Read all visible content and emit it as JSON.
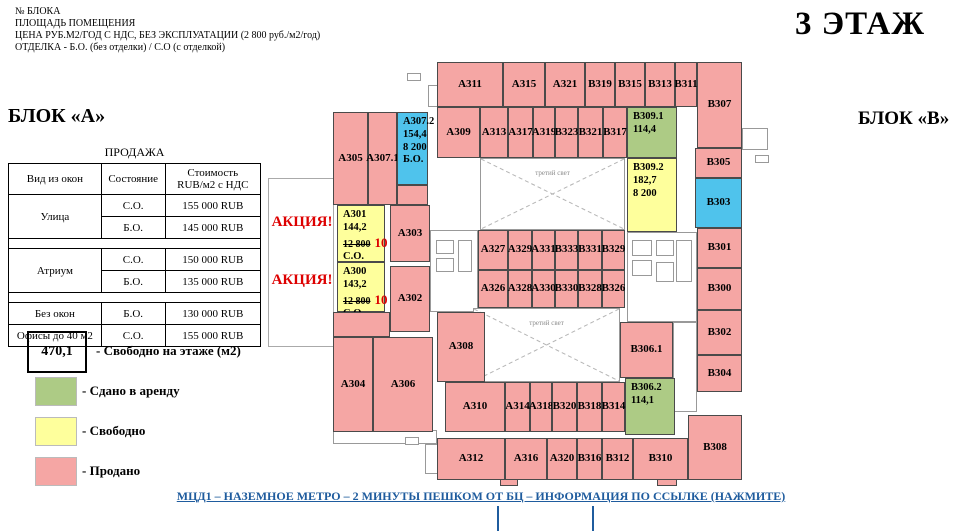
{
  "header_notes": [
    "№ БЛОКА",
    "ПЛОЩАДЬ ПОМЕЩЕНИЯ",
    "ЦЕНА РУБ.М2/ГОД С НДС, БЕЗ ЭКСПЛУАТАЦИИ (2 800 руб./м2/год)",
    "ОТДЕЛКА - Б.О. (без отделки) / С.О (с отделкой)"
  ],
  "floor_title": "3 ЭТАЖ",
  "block_a_label": "БЛОК «А»",
  "block_b_label": "БЛОК «В»",
  "sales": {
    "title": "ПРОДАЖА",
    "col_headers": [
      "Вид из окон",
      "Состояние",
      "Стоимость\nRUB/м2 с НДС"
    ],
    "groups": [
      {
        "view": "Улица",
        "rows": [
          [
            "С.О.",
            "155 000 RUB"
          ],
          [
            "Б.О.",
            "145 000 RUB"
          ]
        ],
        "spacer_after": true
      },
      {
        "view": "Атриум",
        "rows": [
          [
            "С.О.",
            "150 000 RUB"
          ],
          [
            "Б.О.",
            "135 000 RUB"
          ]
        ],
        "spacer_after": true
      },
      {
        "view": "Без окон",
        "rows": [
          [
            "Б.О.",
            "130 000 RUB"
          ]
        ],
        "spacer_after": false
      },
      {
        "view": "Офисы до 40 м2",
        "rows": [
          [
            "С.О.",
            "155 000 RUB"
          ]
        ],
        "spacer_after": false
      }
    ]
  },
  "legend": {
    "free_area_value": "470,1",
    "free_area_label": "- Свободно на этаже (м2)",
    "items": [
      {
        "status": "rented",
        "label": "- Сдано в аренду"
      },
      {
        "status": "free",
        "label": "- Свободно"
      },
      {
        "status": "sold",
        "label": "- Продано"
      }
    ]
  },
  "promo_labels": [
    "АКЦИЯ!",
    "АКЦИЯ!"
  ],
  "footer_link": "МЦД1 – НАЗЕМНОЕ МЕТРО – 2 МИНУТЫ ПЕШКОМ ОТ БЦ – ИНФОРМАЦИЯ ПО ССЫЛКЕ (НАЖМИТЕ)",
  "colors": {
    "sold": "#f5a6a4",
    "free": "#feff9c",
    "rented": "#adcb85",
    "special": "#4fc3ec",
    "promo_red": "#dd0000",
    "link_blue": "#1f5c9e",
    "none": "#ffffff"
  },
  "plan": {
    "atrium_label": "третий свет",
    "atriums": [
      {
        "x": 480,
        "y": 158,
        "w": 145,
        "h": 72
      },
      {
        "x": 473,
        "y": 308,
        "w": 147,
        "h": 74
      }
    ],
    "rooms": [
      {
        "id": "А311",
        "x": 437,
        "y": 62,
        "w": 66,
        "h": 45,
        "status": "sold"
      },
      {
        "id": "А315",
        "x": 503,
        "y": 62,
        "w": 42,
        "h": 45,
        "status": "sold"
      },
      {
        "id": "А321",
        "x": 545,
        "y": 62,
        "w": 40,
        "h": 45,
        "status": "sold"
      },
      {
        "id": "В319",
        "x": 585,
        "y": 62,
        "w": 30,
        "h": 45,
        "status": "sold"
      },
      {
        "id": "В315",
        "x": 615,
        "y": 62,
        "w": 30,
        "h": 45,
        "status": "sold"
      },
      {
        "id": "В313",
        "x": 645,
        "y": 62,
        "w": 30,
        "h": 45,
        "status": "sold"
      },
      {
        "id": "В311",
        "x": 675,
        "y": 62,
        "w": 22,
        "h": 45,
        "status": "sold"
      },
      {
        "id": "В307",
        "x": 697,
        "y": 62,
        "w": 45,
        "h": 86,
        "status": "sold"
      },
      {
        "id": "А309",
        "x": 437,
        "y": 107,
        "w": 43,
        "h": 51,
        "status": "sold"
      },
      {
        "id": "А313",
        "x": 480,
        "y": 107,
        "w": 28,
        "h": 51,
        "status": "sold"
      },
      {
        "id": "А317",
        "x": 508,
        "y": 107,
        "w": 25,
        "h": 51,
        "status": "sold"
      },
      {
        "id": "А319",
        "x": 533,
        "y": 107,
        "w": 22,
        "h": 51,
        "status": "sold"
      },
      {
        "id": "В323",
        "x": 555,
        "y": 107,
        "w": 23,
        "h": 51,
        "status": "sold"
      },
      {
        "id": "В321",
        "x": 578,
        "y": 107,
        "w": 25,
        "h": 51,
        "status": "sold"
      },
      {
        "id": "В317",
        "x": 603,
        "y": 107,
        "w": 24,
        "h": 51,
        "status": "sold"
      },
      {
        "id": "В309.1",
        "x": 627,
        "y": 107,
        "w": 50,
        "h": 51,
        "status": "rented",
        "lines": [
          "114,4"
        ]
      },
      {
        "id": "В309.2",
        "x": 627,
        "y": 158,
        "w": 50,
        "h": 74,
        "status": "free",
        "lines": [
          "182,7",
          "8 200"
        ]
      },
      {
        "id": "В305",
        "x": 695,
        "y": 148,
        "w": 47,
        "h": 30,
        "status": "sold"
      },
      {
        "id": "В303",
        "x": 695,
        "y": 178,
        "w": 47,
        "h": 50,
        "status": "special"
      },
      {
        "id": "В301",
        "x": 697,
        "y": 228,
        "w": 45,
        "h": 40,
        "status": "sold"
      },
      {
        "id": "В300",
        "x": 697,
        "y": 268,
        "w": 45,
        "h": 42,
        "status": "sold"
      },
      {
        "id": "В302",
        "x": 697,
        "y": 310,
        "w": 45,
        "h": 45,
        "status": "sold"
      },
      {
        "id": "В304",
        "x": 697,
        "y": 355,
        "w": 45,
        "h": 37,
        "status": "sold"
      },
      {
        "id": "В308",
        "x": 688,
        "y": 415,
        "w": 54,
        "h": 65,
        "status": "sold"
      },
      {
        "id": "А305",
        "x": 333,
        "y": 112,
        "w": 35,
        "h": 93,
        "status": "sold"
      },
      {
        "id": "А307.1",
        "x": 368,
        "y": 112,
        "w": 29,
        "h": 93,
        "status": "sold"
      },
      {
        "id": "А307.2",
        "x": 397,
        "y": 112,
        "w": 31,
        "h": 73,
        "status": "special",
        "lines": [
          "154,4",
          "8 200",
          "Б.О."
        ]
      },
      {
        "id": "",
        "x": 397,
        "y": 185,
        "w": 31,
        "h": 20,
        "status": "sold"
      },
      {
        "id": "А301",
        "x": 337,
        "y": 205,
        "w": 48,
        "h": 57,
        "status": "free",
        "lines": [
          "144,2",
          {
            "old": "12 800",
            "new": "10 500"
          },
          "С.О."
        ]
      },
      {
        "id": "А303",
        "x": 390,
        "y": 205,
        "w": 40,
        "h": 57,
        "status": "sold"
      },
      {
        "id": "А300",
        "x": 337,
        "y": 262,
        "w": 48,
        "h": 50,
        "status": "free",
        "lines": [
          "143,2",
          {
            "old": "12 800",
            "new": "10 500"
          },
          "С.О."
        ]
      },
      {
        "id": "А302",
        "x": 390,
        "y": 266,
        "w": 40,
        "h": 66,
        "status": "sold"
      },
      {
        "id": "",
        "x": 333,
        "y": 312,
        "w": 57,
        "h": 25,
        "status": "sold"
      },
      {
        "id": "А304",
        "x": 333,
        "y": 337,
        "w": 40,
        "h": 95,
        "status": "sold"
      },
      {
        "id": "А306",
        "x": 373,
        "y": 337,
        "w": 60,
        "h": 95,
        "status": "sold"
      },
      {
        "id": "А308",
        "x": 437,
        "y": 312,
        "w": 48,
        "h": 70,
        "status": "sold"
      },
      {
        "id": "А327",
        "x": 478,
        "y": 230,
        "w": 30,
        "h": 40,
        "status": "sold"
      },
      {
        "id": "А329",
        "x": 508,
        "y": 230,
        "w": 24,
        "h": 40,
        "status": "sold"
      },
      {
        "id": "А331",
        "x": 532,
        "y": 230,
        "w": 23,
        "h": 40,
        "status": "sold"
      },
      {
        "id": "В333",
        "x": 555,
        "y": 230,
        "w": 23,
        "h": 40,
        "status": "sold"
      },
      {
        "id": "В331",
        "x": 578,
        "y": 230,
        "w": 24,
        "h": 40,
        "status": "sold"
      },
      {
        "id": "В329",
        "x": 602,
        "y": 230,
        "w": 23,
        "h": 40,
        "status": "sold"
      },
      {
        "id": "А326",
        "x": 478,
        "y": 270,
        "w": 30,
        "h": 38,
        "status": "sold"
      },
      {
        "id": "А328",
        "x": 508,
        "y": 270,
        "w": 24,
        "h": 38,
        "status": "sold"
      },
      {
        "id": "А330",
        "x": 532,
        "y": 270,
        "w": 23,
        "h": 38,
        "status": "sold"
      },
      {
        "id": "В330",
        "x": 555,
        "y": 270,
        "w": 23,
        "h": 38,
        "status": "sold"
      },
      {
        "id": "В328",
        "x": 578,
        "y": 270,
        "w": 24,
        "h": 38,
        "status": "sold"
      },
      {
        "id": "В326",
        "x": 602,
        "y": 270,
        "w": 23,
        "h": 38,
        "status": "sold"
      },
      {
        "id": "В306.1",
        "x": 620,
        "y": 322,
        "w": 53,
        "h": 56,
        "status": "sold"
      },
      {
        "id": "В306.2",
        "x": 625,
        "y": 378,
        "w": 50,
        "h": 57,
        "status": "rented",
        "lines": [
          "114,1"
        ]
      },
      {
        "id": "А310",
        "x": 445,
        "y": 382,
        "w": 60,
        "h": 50,
        "status": "sold"
      },
      {
        "id": "А314",
        "x": 505,
        "y": 382,
        "w": 25,
        "h": 50,
        "status": "sold"
      },
      {
        "id": "А318",
        "x": 530,
        "y": 382,
        "w": 22,
        "h": 50,
        "status": "sold"
      },
      {
        "id": "В320",
        "x": 552,
        "y": 382,
        "w": 25,
        "h": 50,
        "status": "sold"
      },
      {
        "id": "В318",
        "x": 577,
        "y": 382,
        "w": 25,
        "h": 50,
        "status": "sold"
      },
      {
        "id": "В314",
        "x": 602,
        "y": 382,
        "w": 23,
        "h": 50,
        "status": "sold"
      },
      {
        "id": "А312",
        "x": 437,
        "y": 438,
        "w": 68,
        "h": 42,
        "status": "sold"
      },
      {
        "id": "А316",
        "x": 505,
        "y": 438,
        "w": 42,
        "h": 42,
        "status": "sold"
      },
      {
        "id": "А320",
        "x": 547,
        "y": 438,
        "w": 30,
        "h": 42,
        "status": "sold"
      },
      {
        "id": "В316",
        "x": 577,
        "y": 438,
        "w": 25,
        "h": 42,
        "status": "sold"
      },
      {
        "id": "В312",
        "x": 602,
        "y": 438,
        "w": 31,
        "h": 42,
        "status": "sold"
      },
      {
        "id": "В310",
        "x": 633,
        "y": 438,
        "w": 55,
        "h": 42,
        "status": "sold"
      }
    ]
  }
}
